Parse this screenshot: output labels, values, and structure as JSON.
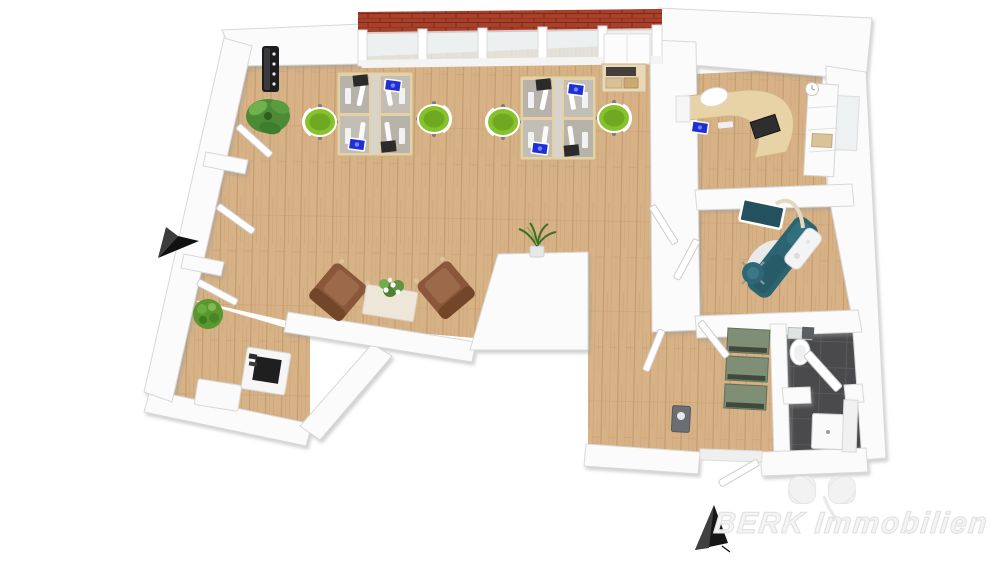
{
  "image_type": "3d-floor-plan-render-top-view",
  "watermark": {
    "brand": "BERK Immobilien",
    "logo_icon": "four-leaf-clover"
  },
  "indicators": {
    "arrows": [
      {
        "name": "entrance-arrow-left",
        "direction": "north-east"
      },
      {
        "name": "entrance-arrow-bottom",
        "direction": "north-west"
      }
    ]
  },
  "palette": {
    "floor_wood": "#d7b286",
    "floor_grain": "#c49c6e",
    "wall_white": "#fbfbfb",
    "wall_edge": "#d8d8d8",
    "roof_red": "#a8402a",
    "window_glass": "#e7ecee",
    "office_chair_green": "#85c22b",
    "armchair_brown": "#8a573a",
    "dental_chair_teal": "#2c6472",
    "locker_green": "#7e8f75",
    "bathroom_tile": "#4a4a4c",
    "laptop_screen_blue": "#1f2fd4",
    "desk_beech": "#e6d1a4",
    "arrow_black": "#161616",
    "watermark_gray": "#e2e2e2"
  },
  "rooms": [
    {
      "name": "open-plan-office",
      "floor": "wood",
      "objects": [
        "desk-pod-4-person",
        "desk-pod-4-person",
        "office-chair-green",
        "office-chair-green",
        "office-chair-green",
        "office-chair-green",
        "storage-cabinet",
        "shelf-with-boxes",
        "coat-rack",
        "palm-plant",
        "round-plant",
        "niche-plant",
        "armchair",
        "armchair",
        "coffee-table-with-flowers",
        "sideboard",
        "printer-copier"
      ]
    },
    {
      "name": "private-office",
      "floor": "wood",
      "objects": [
        "curved-desk",
        "desk-chair-white",
        "monitor",
        "laptop-blue",
        "wall-shelf",
        "wall-clock"
      ]
    },
    {
      "name": "treatment-room",
      "floor": "wood",
      "objects": [
        "dental-chair",
        "equipment-unit",
        "overhead-monitor-lamp",
        "stool-teal"
      ]
    },
    {
      "name": "hallway",
      "floor": "wood",
      "objects": [
        "locker-bank-green",
        "wall-sink"
      ]
    },
    {
      "name": "bathroom",
      "floor": "dark-tile",
      "objects": [
        "toilet",
        "sink-cabinet",
        "diagonal-door"
      ]
    }
  ],
  "architecture": {
    "window_front": "glazed top wall with red tile roof strip",
    "open_doors_count": 8,
    "entrances": 2
  }
}
